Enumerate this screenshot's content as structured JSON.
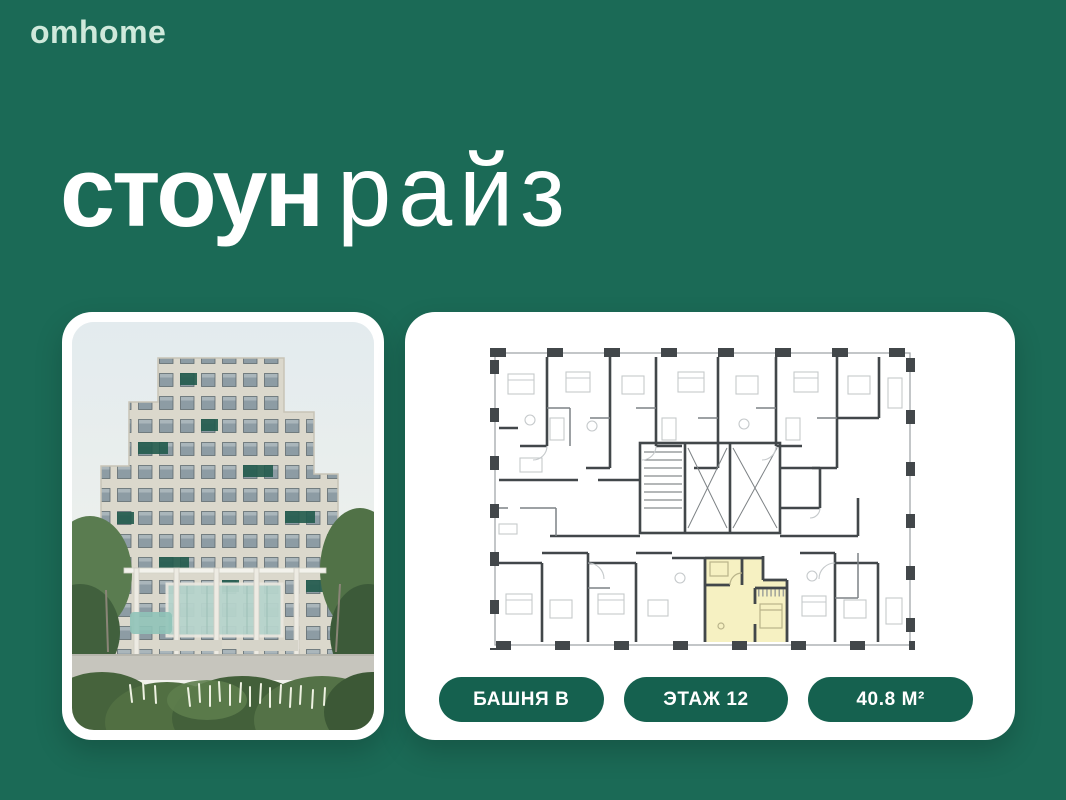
{
  "header": {
    "logo": "omhome"
  },
  "title": {
    "bold": "стоун",
    "light": "райз"
  },
  "colors": {
    "background_green": "#1b6a56",
    "badge_green": "#15614f",
    "logo_mint": "#cfe9db",
    "plan_highlight_yellow": "#f6f1c2",
    "plan_wall_gray": "#42474a",
    "title_white": "#ffffff"
  },
  "building_photo": {
    "description": "stepped residential tower render with garden and pergola"
  },
  "floor_plan": {
    "type": "apartment-floor-plan",
    "highlighted_unit": {
      "tower": "В",
      "floor": "12",
      "area": "40.8 М²"
    }
  },
  "badges": [
    {
      "label": "БАШНЯ В"
    },
    {
      "label": "ЭТАЖ 12"
    },
    {
      "label": "40.8 М²"
    }
  ]
}
